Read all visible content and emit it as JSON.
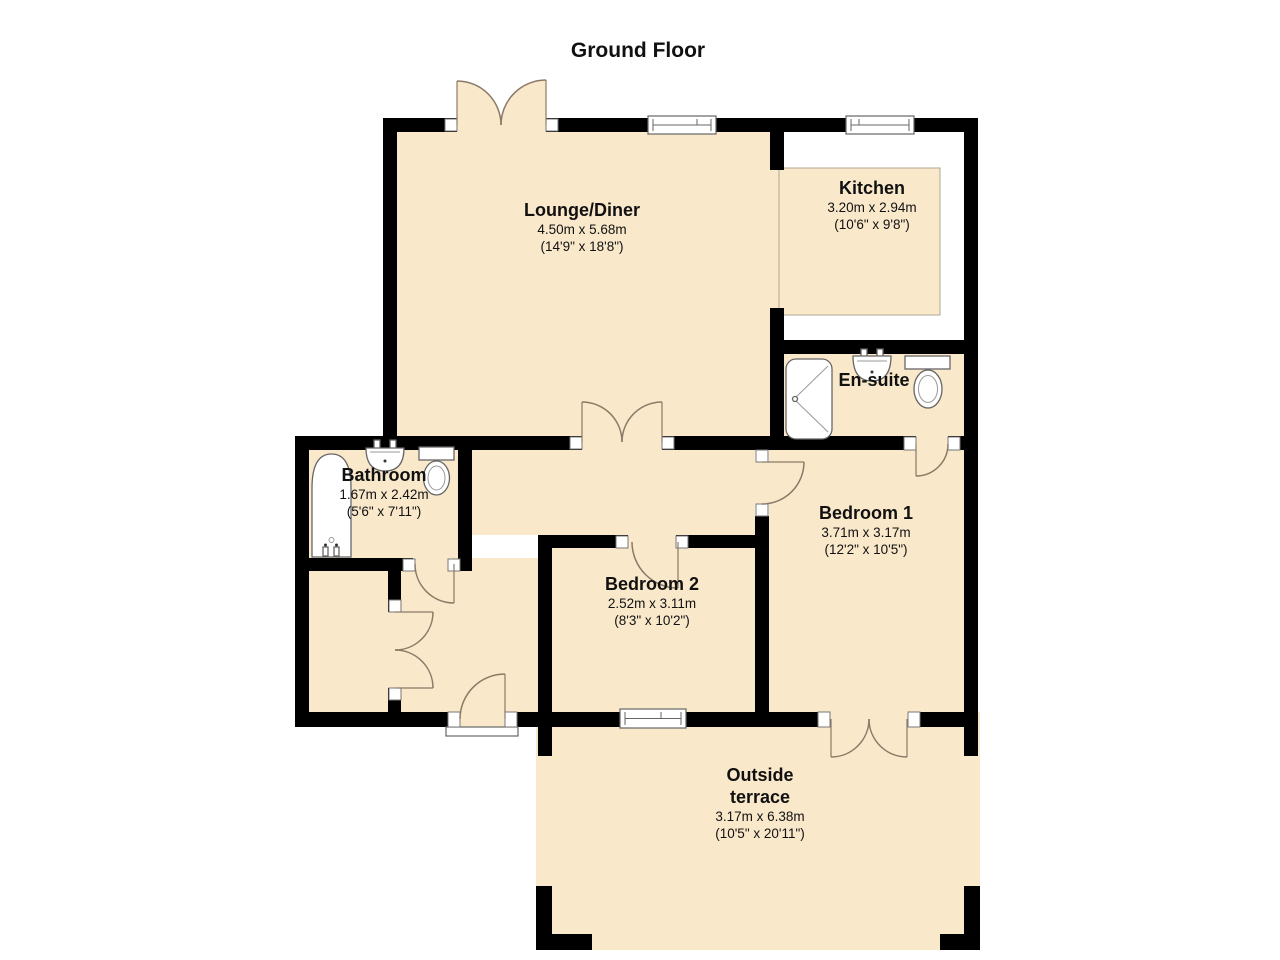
{
  "title": "Ground Floor",
  "colors": {
    "floor_fill": "#FAE8CB",
    "wall": "#000000",
    "door_arc": "#8A7A66",
    "fixture_stroke": "#666666"
  },
  "rooms": {
    "lounge": {
      "name": "Lounge/Diner",
      "metric": "4.50m x 5.68m",
      "imperial": "(14'9\" x 18'8\")"
    },
    "kitchen": {
      "name": "Kitchen",
      "metric": "3.20m x 2.94m",
      "imperial": "(10'6\" x 9'8\")"
    },
    "ensuite": {
      "name": "En-suite"
    },
    "bathroom": {
      "name": "Bathroom",
      "metric": "1.67m x 2.42m",
      "imperial": "(5'6\" x 7'11\")"
    },
    "bedroom1": {
      "name": "Bedroom 1",
      "metric": "3.71m x 3.17m",
      "imperial": "(12'2\" x 10'5\")"
    },
    "bedroom2": {
      "name": "Bedroom 2",
      "metric": "2.52m x 3.11m",
      "imperial": "(8'3\" x 10'2\")"
    },
    "terrace": {
      "name_line1": "Outside",
      "name_line2": "terrace",
      "metric": "3.17m x 6.38m",
      "imperial": "(10'5\" x 20'11\")"
    }
  },
  "fixtures": {
    "bathroom": [
      "bathtub",
      "sink",
      "toilet"
    ],
    "ensuite": [
      "shower",
      "sink",
      "toilet"
    ]
  }
}
